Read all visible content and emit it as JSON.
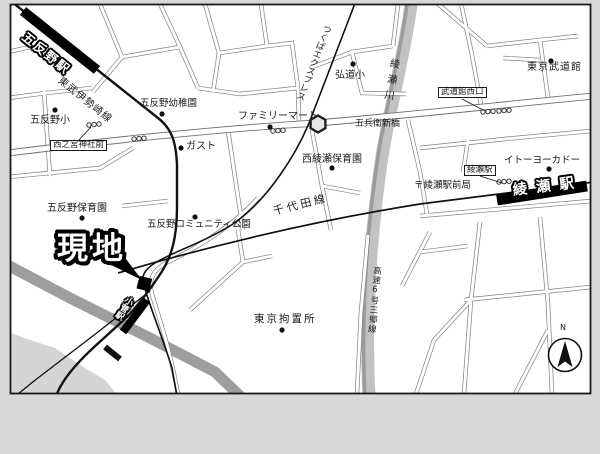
{
  "map": {
    "site_marker": {
      "label": "現地"
    },
    "compass": {
      "label": "N"
    },
    "stations": [
      {
        "name": "五反野駅"
      },
      {
        "name": "綾瀬駅"
      },
      {
        "name": "小菅駅"
      }
    ],
    "rail_lines": [
      {
        "name": "東武伊勢崎線"
      },
      {
        "name": "つくばエクスプレス"
      },
      {
        "name": "千代田線"
      }
    ],
    "river": {
      "name": "綾瀬川"
    },
    "expressway": {
      "name": "高速6号三郷線"
    },
    "bridge": {
      "name": "五兵衛新橋"
    },
    "bus_stops": [
      {
        "name": "西之宮神社前"
      },
      {
        "name": "武道館西口"
      },
      {
        "name": "綾瀬駅"
      }
    ],
    "pois": [
      {
        "name": "五反野小"
      },
      {
        "name": "五反野幼稚園"
      },
      {
        "name": "ファミリーマート"
      },
      {
        "name": "弘道小"
      },
      {
        "name": "ガスト"
      },
      {
        "name": "西綾瀬保育園"
      },
      {
        "name": "五反野保育園"
      },
      {
        "name": "五反野コミュニティ公園"
      },
      {
        "name": "東京拘置所"
      },
      {
        "name": "東京武道館"
      },
      {
        "name": "イトーヨーカドー"
      },
      {
        "name": "〒綾瀬駅前局"
      }
    ],
    "colors": {
      "background": "#d8d8d8",
      "map_bg": "#ffffff",
      "river_band": "#c2c2c2",
      "road_band": "#9e9e9e",
      "ink": "#1a1a1a"
    }
  }
}
